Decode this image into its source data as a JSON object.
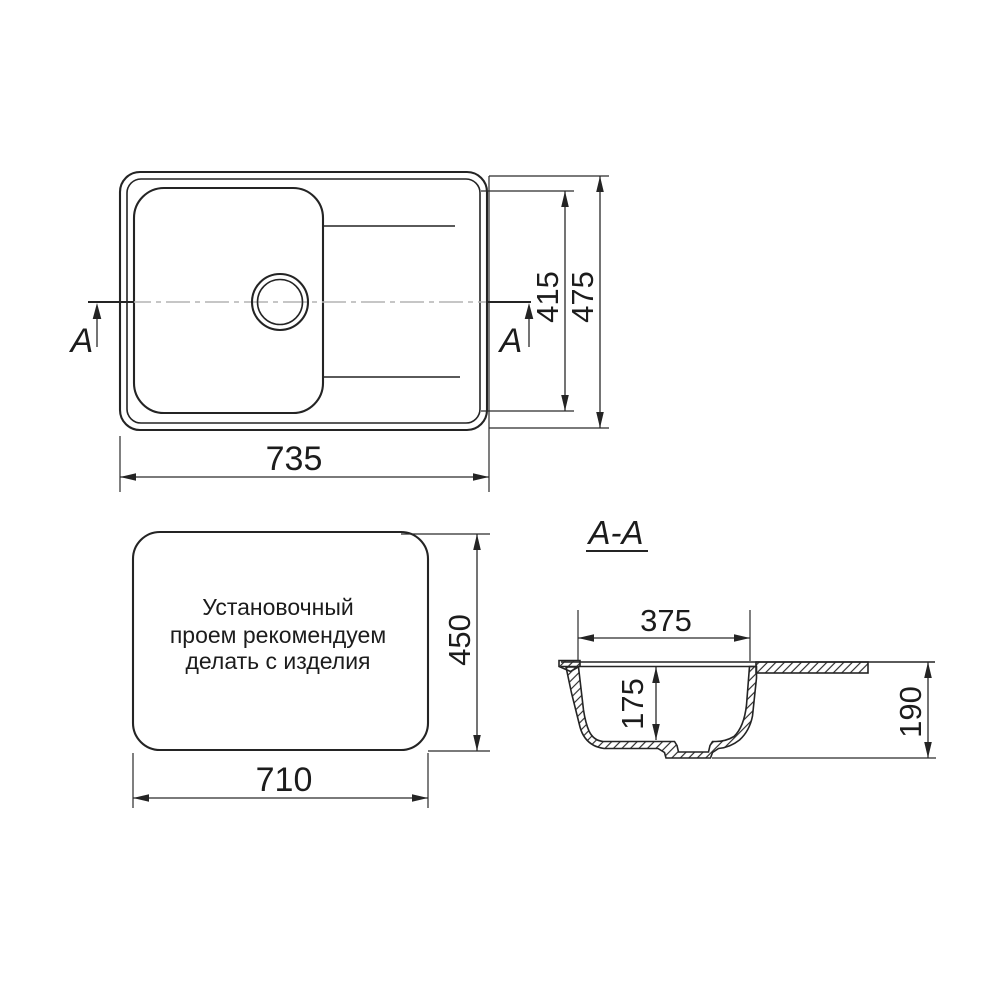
{
  "top_view": {
    "section_arrow_label": "A",
    "dims": {
      "width": "735",
      "inner_height": "415",
      "overall_height": "475"
    }
  },
  "cutout_view": {
    "note_line1": "Установочный",
    "note_line2": "проем рекомендуем",
    "note_line3": "делать с изделия",
    "dims": {
      "width": "710",
      "height": "450"
    }
  },
  "section_view": {
    "title": "A-A",
    "dims": {
      "bowl_width": "375",
      "bowl_depth": "175",
      "overall_height": "190"
    }
  },
  "colors": {
    "line": "#242424",
    "centerline": "#b4b4b4",
    "background": "#ffffff"
  }
}
